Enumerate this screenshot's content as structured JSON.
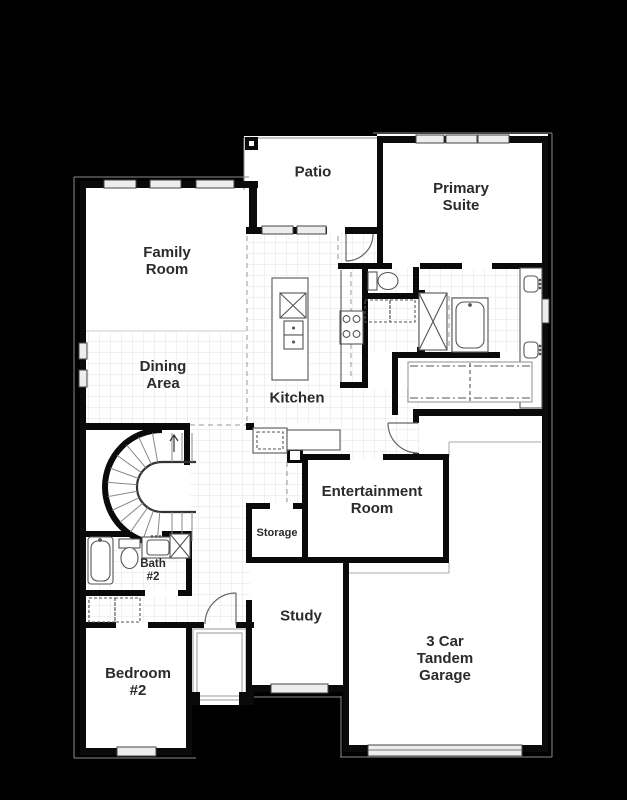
{
  "canvas": {
    "width": 627,
    "height": 800,
    "background": "#000000"
  },
  "colors": {
    "wall": "#0a0a0a",
    "floor": "#ffffff",
    "tile_line": "#e3e3e3",
    "window_fill": "#ededed",
    "fixture_line": "#555555",
    "dash_line": "#999999",
    "thin_outline": "#8a8a8a",
    "label_text": "#2b2b2b"
  },
  "rooms": [
    {
      "id": "patio",
      "label": "Patio",
      "x": 313,
      "y": 173,
      "font": 15
    },
    {
      "id": "primary-suite",
      "label": "Primary\nSuite",
      "x": 461,
      "y": 198,
      "font": 15
    },
    {
      "id": "family-room",
      "label": "Family\nRoom",
      "x": 167,
      "y": 262,
      "font": 15
    },
    {
      "id": "dining-area",
      "label": "Dining\nArea",
      "x": 163,
      "y": 376,
      "font": 15
    },
    {
      "id": "kitchen",
      "label": "Kitchen",
      "x": 297,
      "y": 399,
      "font": 15
    },
    {
      "id": "entertainment-room",
      "label": "Entertainment\nRoom",
      "x": 372,
      "y": 501,
      "font": 15
    },
    {
      "id": "storage",
      "label": "Storage",
      "x": 277,
      "y": 533,
      "font": 11
    },
    {
      "id": "bath-2",
      "label": "Bath\n#2",
      "x": 153,
      "y": 571,
      "font": 11.5
    },
    {
      "id": "study",
      "label": "Study",
      "x": 301,
      "y": 617,
      "font": 15
    },
    {
      "id": "bedroom-2",
      "label": "Bedroom\n#2",
      "x": 138,
      "y": 683,
      "font": 15
    },
    {
      "id": "garage",
      "label": "3 Car\nTandem\nGarage",
      "x": 445,
      "y": 659,
      "font": 15
    }
  ]
}
